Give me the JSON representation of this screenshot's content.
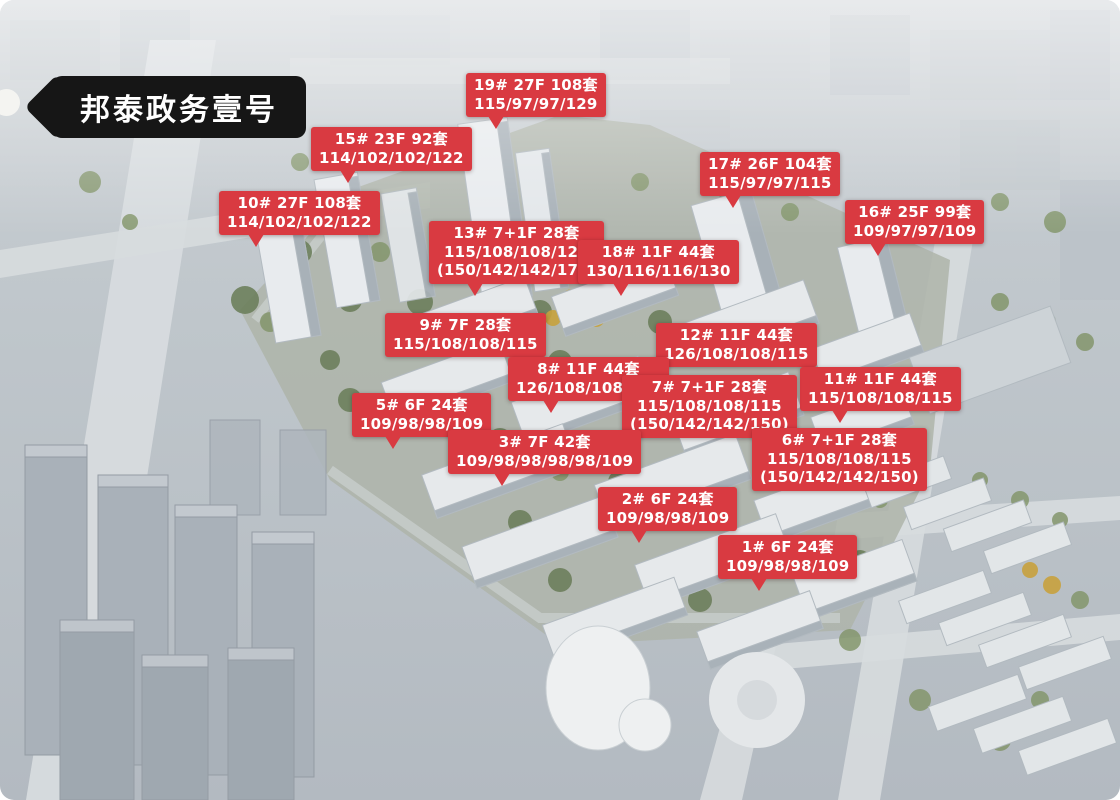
{
  "banner": {
    "title": "邦泰政务壹号"
  },
  "colors": {
    "label_bg": "#d93a41",
    "label_text": "#ffffff",
    "banner_bg": "#161616",
    "banner_text": "#ffffff"
  },
  "labels": [
    {
      "building": "19#",
      "floors": "27F",
      "units": "108套",
      "layouts": "115/97/97/129",
      "special_layouts": "",
      "lines": [
        "19# 27F 108套",
        "115/97/97/129"
      ],
      "pos": {
        "x": 466,
        "y": 73
      },
      "tail": true,
      "tail_left": 16
    },
    {
      "building": "15#",
      "floors": "23F",
      "units": "92套",
      "layouts": "114/102/102/122",
      "special_layouts": "",
      "lines": [
        "15# 23F 92套",
        "114/102/102/122"
      ],
      "pos": {
        "x": 311,
        "y": 127
      },
      "tail": true,
      "tail_left": 18
    },
    {
      "building": "17#",
      "floors": "26F",
      "units": "104套",
      "layouts": "115/97/97/115",
      "special_layouts": "",
      "lines": [
        "17# 26F 104套",
        "115/97/97/115"
      ],
      "pos": {
        "x": 700,
        "y": 152
      },
      "tail": true,
      "tail_left": 18
    },
    {
      "building": "10#",
      "floors": "27F",
      "units": "108套",
      "layouts": "114/102/102/122",
      "special_layouts": "",
      "lines": [
        "10# 27F 108套",
        "114/102/102/122"
      ],
      "pos": {
        "x": 219,
        "y": 191
      },
      "tail": true,
      "tail_left": 18
    },
    {
      "building": "16#",
      "floors": "25F",
      "units": "99套",
      "layouts": "109/97/97/109",
      "special_layouts": "",
      "lines": [
        "16# 25F 99套",
        "109/97/97/109"
      ],
      "pos": {
        "x": 845,
        "y": 200
      },
      "tail": true,
      "tail_left": 18
    },
    {
      "building": "13#",
      "floors": "7+1F",
      "units": "28套",
      "layouts": "115/108/108/126",
      "special_layouts": "(150/142/142/177)",
      "lines": [
        "13# 7+1F 28套",
        "115/108/108/126",
        "(150/142/142/177)"
      ],
      "pos": {
        "x": 429,
        "y": 221
      },
      "tail": true,
      "tail_left": 22
    },
    {
      "building": "18#",
      "floors": "11F",
      "units": "44套",
      "layouts": "130/116/116/130",
      "special_layouts": "",
      "lines": [
        "18# 11F 44套",
        "130/116/116/130"
      ],
      "pos": {
        "x": 578,
        "y": 240
      },
      "tail": true,
      "tail_left": 22
    },
    {
      "building": "9#",
      "floors": "7F",
      "units": "28套",
      "layouts": "115/108/108/115",
      "special_layouts": "",
      "lines": [
        "9# 7F 28套",
        "115/108/108/115"
      ],
      "pos": {
        "x": 385,
        "y": 313
      },
      "tail": false,
      "tail_left": 20
    },
    {
      "building": "12#",
      "floors": "11F",
      "units": "44套",
      "layouts": "126/108/108/115",
      "special_layouts": "",
      "lines": [
        "12# 11F 44套",
        "126/108/108/115"
      ],
      "pos": {
        "x": 656,
        "y": 323
      },
      "tail": false,
      "tail_left": 20
    },
    {
      "building": "8#",
      "floors": "11F",
      "units": "44套",
      "layouts": "126/108/108/126",
      "special_layouts": "",
      "lines": [
        "8# 11F 44套",
        "126/108/108/126"
      ],
      "pos": {
        "x": 508,
        "y": 357
      },
      "tail": true,
      "tail_left": 22
    },
    {
      "building": "11#",
      "floors": "11F",
      "units": "44套",
      "layouts": "115/108/108/115",
      "special_layouts": "",
      "lines": [
        "11# 11F 44套",
        "115/108/108/115"
      ],
      "pos": {
        "x": 800,
        "y": 367
      },
      "tail": true,
      "tail_left": 20
    },
    {
      "building": "7#",
      "floors": "7+1F",
      "units": "28套",
      "layouts": "115/108/108/115",
      "special_layouts": "(150/142/142/150)",
      "lines": [
        "7# 7+1F 28套",
        "115/108/108/115",
        "(150/142/142/150)"
      ],
      "pos": {
        "x": 622,
        "y": 375
      },
      "tail": false,
      "tail_left": 20
    },
    {
      "building": "5#",
      "floors": "6F",
      "units": "24套",
      "layouts": "109/98/98/109",
      "special_layouts": "",
      "lines": [
        "5# 6F 24套",
        "109/98/98/109"
      ],
      "pos": {
        "x": 352,
        "y": 393
      },
      "tail": true,
      "tail_left": 24
    },
    {
      "building": "6#",
      "floors": "7+1F",
      "units": "28套",
      "layouts": "115/108/108/115",
      "special_layouts": "(150/142/142/150)",
      "lines": [
        "6# 7+1F 28套",
        "115/108/108/115",
        "(150/142/142/150)"
      ],
      "pos": {
        "x": 752,
        "y": 428
      },
      "tail": false,
      "tail_left": 20
    },
    {
      "building": "3#",
      "floors": "7F",
      "units": "42套",
      "layouts": "109/98/98/98/98/109",
      "special_layouts": "",
      "lines": [
        "3# 7F 42套",
        "109/98/98/98/98/109"
      ],
      "pos": {
        "x": 448,
        "y": 430
      },
      "tail": true,
      "tail_left": 24
    },
    {
      "building": "2#",
      "floors": "6F",
      "units": "24套",
      "layouts": "109/98/98/109",
      "special_layouts": "",
      "lines": [
        "2# 6F 24套",
        "109/98/98/109"
      ],
      "pos": {
        "x": 598,
        "y": 487
      },
      "tail": true,
      "tail_left": 24
    },
    {
      "building": "1#",
      "floors": "6F",
      "units": "24套",
      "layouts": "109/98/98/109",
      "special_layouts": "",
      "lines": [
        "1# 6F 24套",
        "109/98/98/109"
      ],
      "pos": {
        "x": 718,
        "y": 535
      },
      "tail": true,
      "tail_left": 24
    }
  ]
}
